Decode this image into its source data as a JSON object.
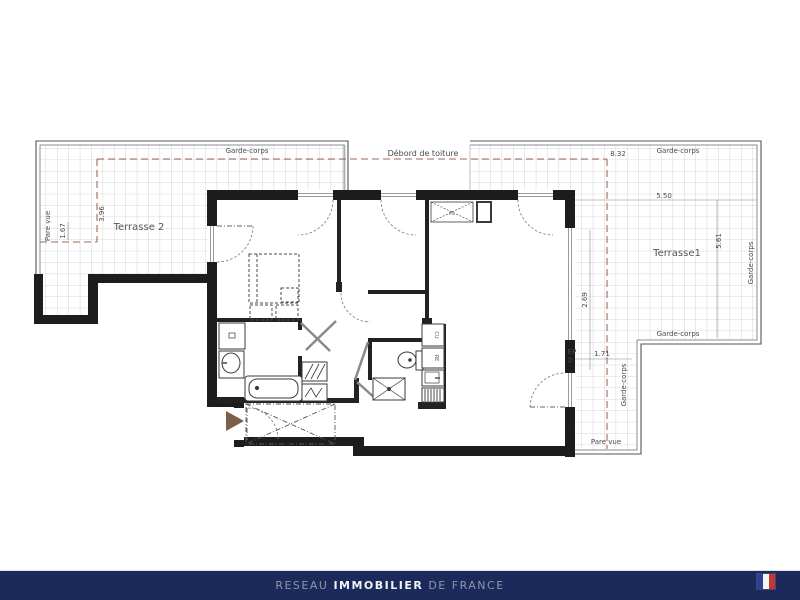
{
  "plan": {
    "roof_label": "Débord de toiture",
    "terrace2": {
      "name": "Terrasse 2",
      "garde_corps": "Garde-corps",
      "pare_vue": "Pare vue",
      "dim_depth": "3.96",
      "dim_inner": "1.67"
    },
    "terrace1": {
      "name": "Terrasse1",
      "garde_corps_top": "Garde-corps",
      "garde_corps_right": "Garde-corps",
      "garde_corps_bottom": "Garde-corps",
      "garde_corps_strip": "Garde-corps",
      "pare_vue": "Pare vue",
      "dim_width": "8.32",
      "dim_top": "5.50",
      "dim_right": "5.61",
      "dim_wall": "2.69",
      "dim_strip": "1.71",
      "ep_label": "EP"
    },
    "closet_label": "PL",
    "kitchen": {
      "hob": "CU",
      "fridge": "RE"
    }
  },
  "footer": {
    "brand_prefix": "RESEAU ",
    "brand_main": "IMMOBILIER",
    "brand_suffix": " DE FRANCE"
  },
  "colors": {
    "footer_bg": "#1b2a5b",
    "wall": "#1d1d1d",
    "dashed_line": "#9b6a55",
    "flag_blue": "#2f3f94",
    "flag_red": "#c4372f",
    "arrow": "#7d5f49"
  }
}
